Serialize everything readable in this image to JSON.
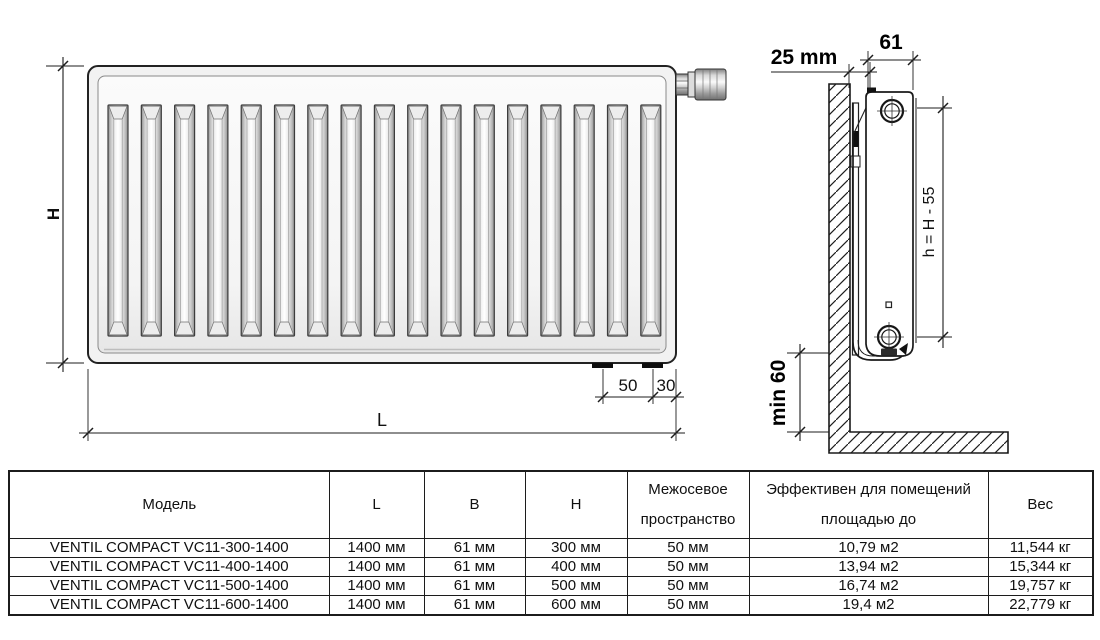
{
  "drawing": {
    "front_view": {
      "channel_count": 17,
      "dim_height_label": "H",
      "dim_length_label": "L",
      "dim_bracket_offset": "50",
      "dim_edge_offset": "30"
    },
    "side_view": {
      "dim_wall_gap": "25 mm",
      "dim_depth": "61",
      "dim_pipe_spacing": "h = H - 55",
      "dim_floor_clearance": "min 60"
    },
    "line_color": "#1d1d1d"
  },
  "table": {
    "headers": [
      "Модель",
      "L",
      "B",
      "H",
      "Межосевое пространство",
      "Эффективен для помещений площадью до",
      "Вес"
    ],
    "rows": [
      [
        "VENTIL COMPACT VC11-300-1400",
        "1400 мм",
        "61 мм",
        "300 мм",
        "50 мм",
        "10,79 м2",
        "11,544 кг"
      ],
      [
        "VENTIL COMPACT VC11-400-1400",
        "1400 мм",
        "61 мм",
        "400 мм",
        "50 мм",
        "13,94 м2",
        "15,344 кг"
      ],
      [
        "VENTIL COMPACT VC11-500-1400",
        "1400 мм",
        "61 мм",
        "500 мм",
        "50 мм",
        "16,74 м2",
        "19,757 кг"
      ],
      [
        "VENTIL COMPACT VC11-600-1400",
        "1400 мм",
        "61 мм",
        "600 мм",
        "50 мм",
        "19,4 м2",
        "22,779 кг"
      ]
    ]
  }
}
